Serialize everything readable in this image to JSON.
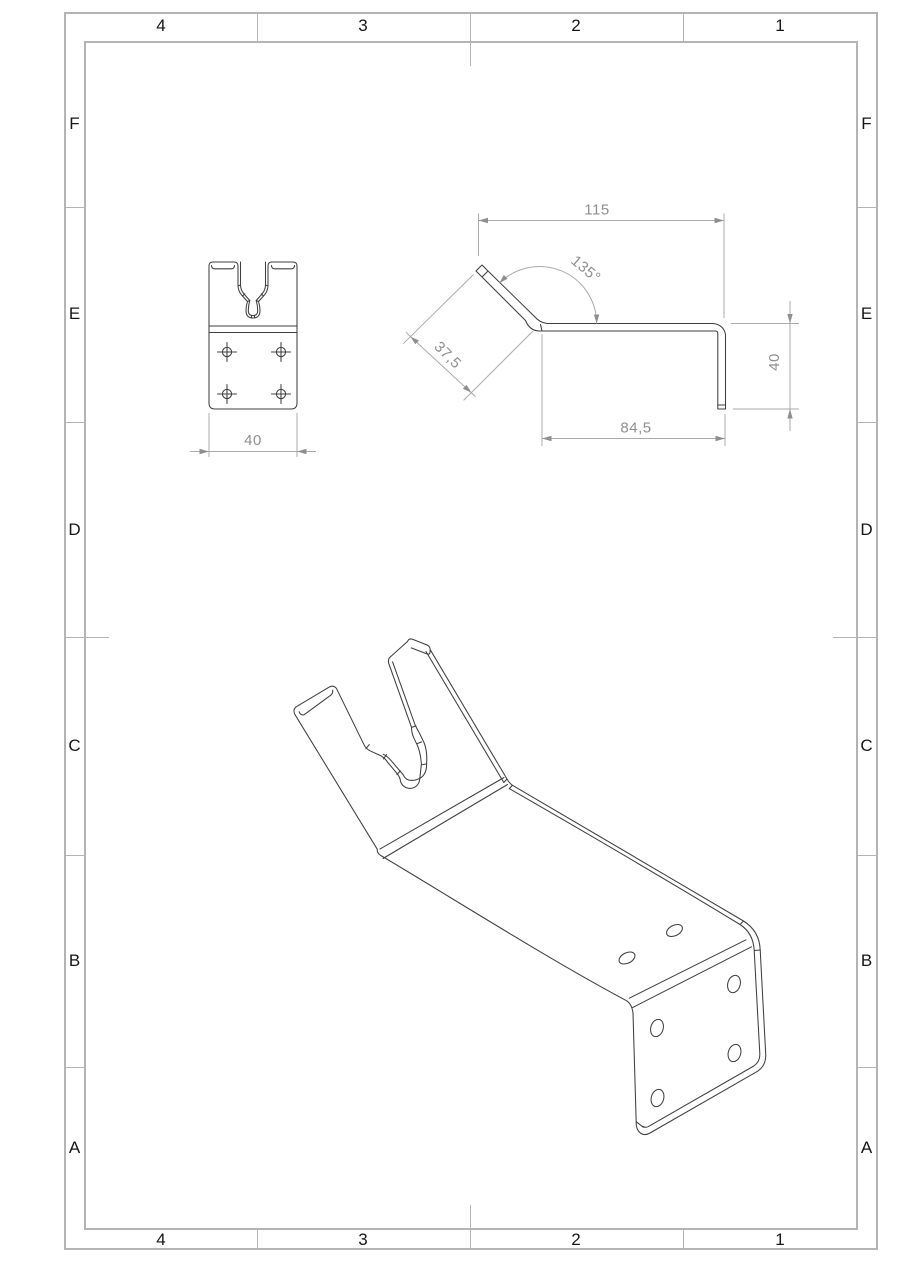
{
  "sheet": {
    "columns": [
      "4",
      "3",
      "2",
      "1"
    ],
    "rows": [
      "F",
      "E",
      "D",
      "C",
      "B",
      "A"
    ],
    "colors": {
      "background": "#ffffff",
      "frame": "#b4b4b4",
      "part_line": "#3f3f3f",
      "dimension": "#8f8f8f"
    }
  },
  "views": {
    "front": {
      "label": "front-view",
      "dims": {
        "width": "40"
      }
    },
    "side": {
      "label": "side-profile-view",
      "dims": {
        "overall_width": "115",
        "bend_angle": "135°",
        "arm_length": "37,5",
        "base_length": "84,5",
        "height": "40"
      }
    },
    "iso": {
      "label": "isometric-view"
    }
  }
}
